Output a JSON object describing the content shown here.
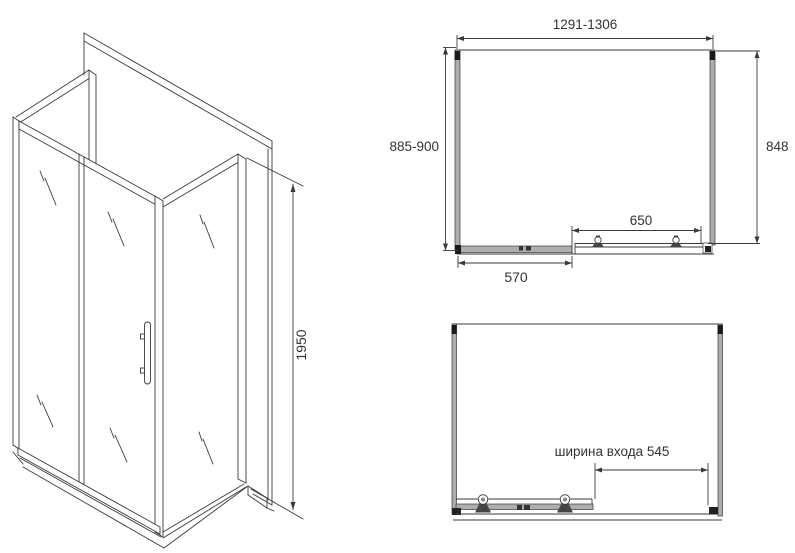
{
  "page": {
    "background": "#ffffff"
  },
  "colors": {
    "line": "#3a3a3a",
    "profile_fill": "#adadad",
    "accent_dark": "#1a1a1a",
    "text": "#333333"
  },
  "isometric_view": {
    "height_dimension": "1950"
  },
  "top_view": {
    "overall_width_dimension": "1291-1306",
    "side_depth_dimension": "885-900",
    "inner_depth_dimension": "848",
    "sliding_door_dimension": "650",
    "fixed_panel_dimension": "570"
  },
  "front_view": {
    "entrance_width_label": "ширина входа 545"
  }
}
